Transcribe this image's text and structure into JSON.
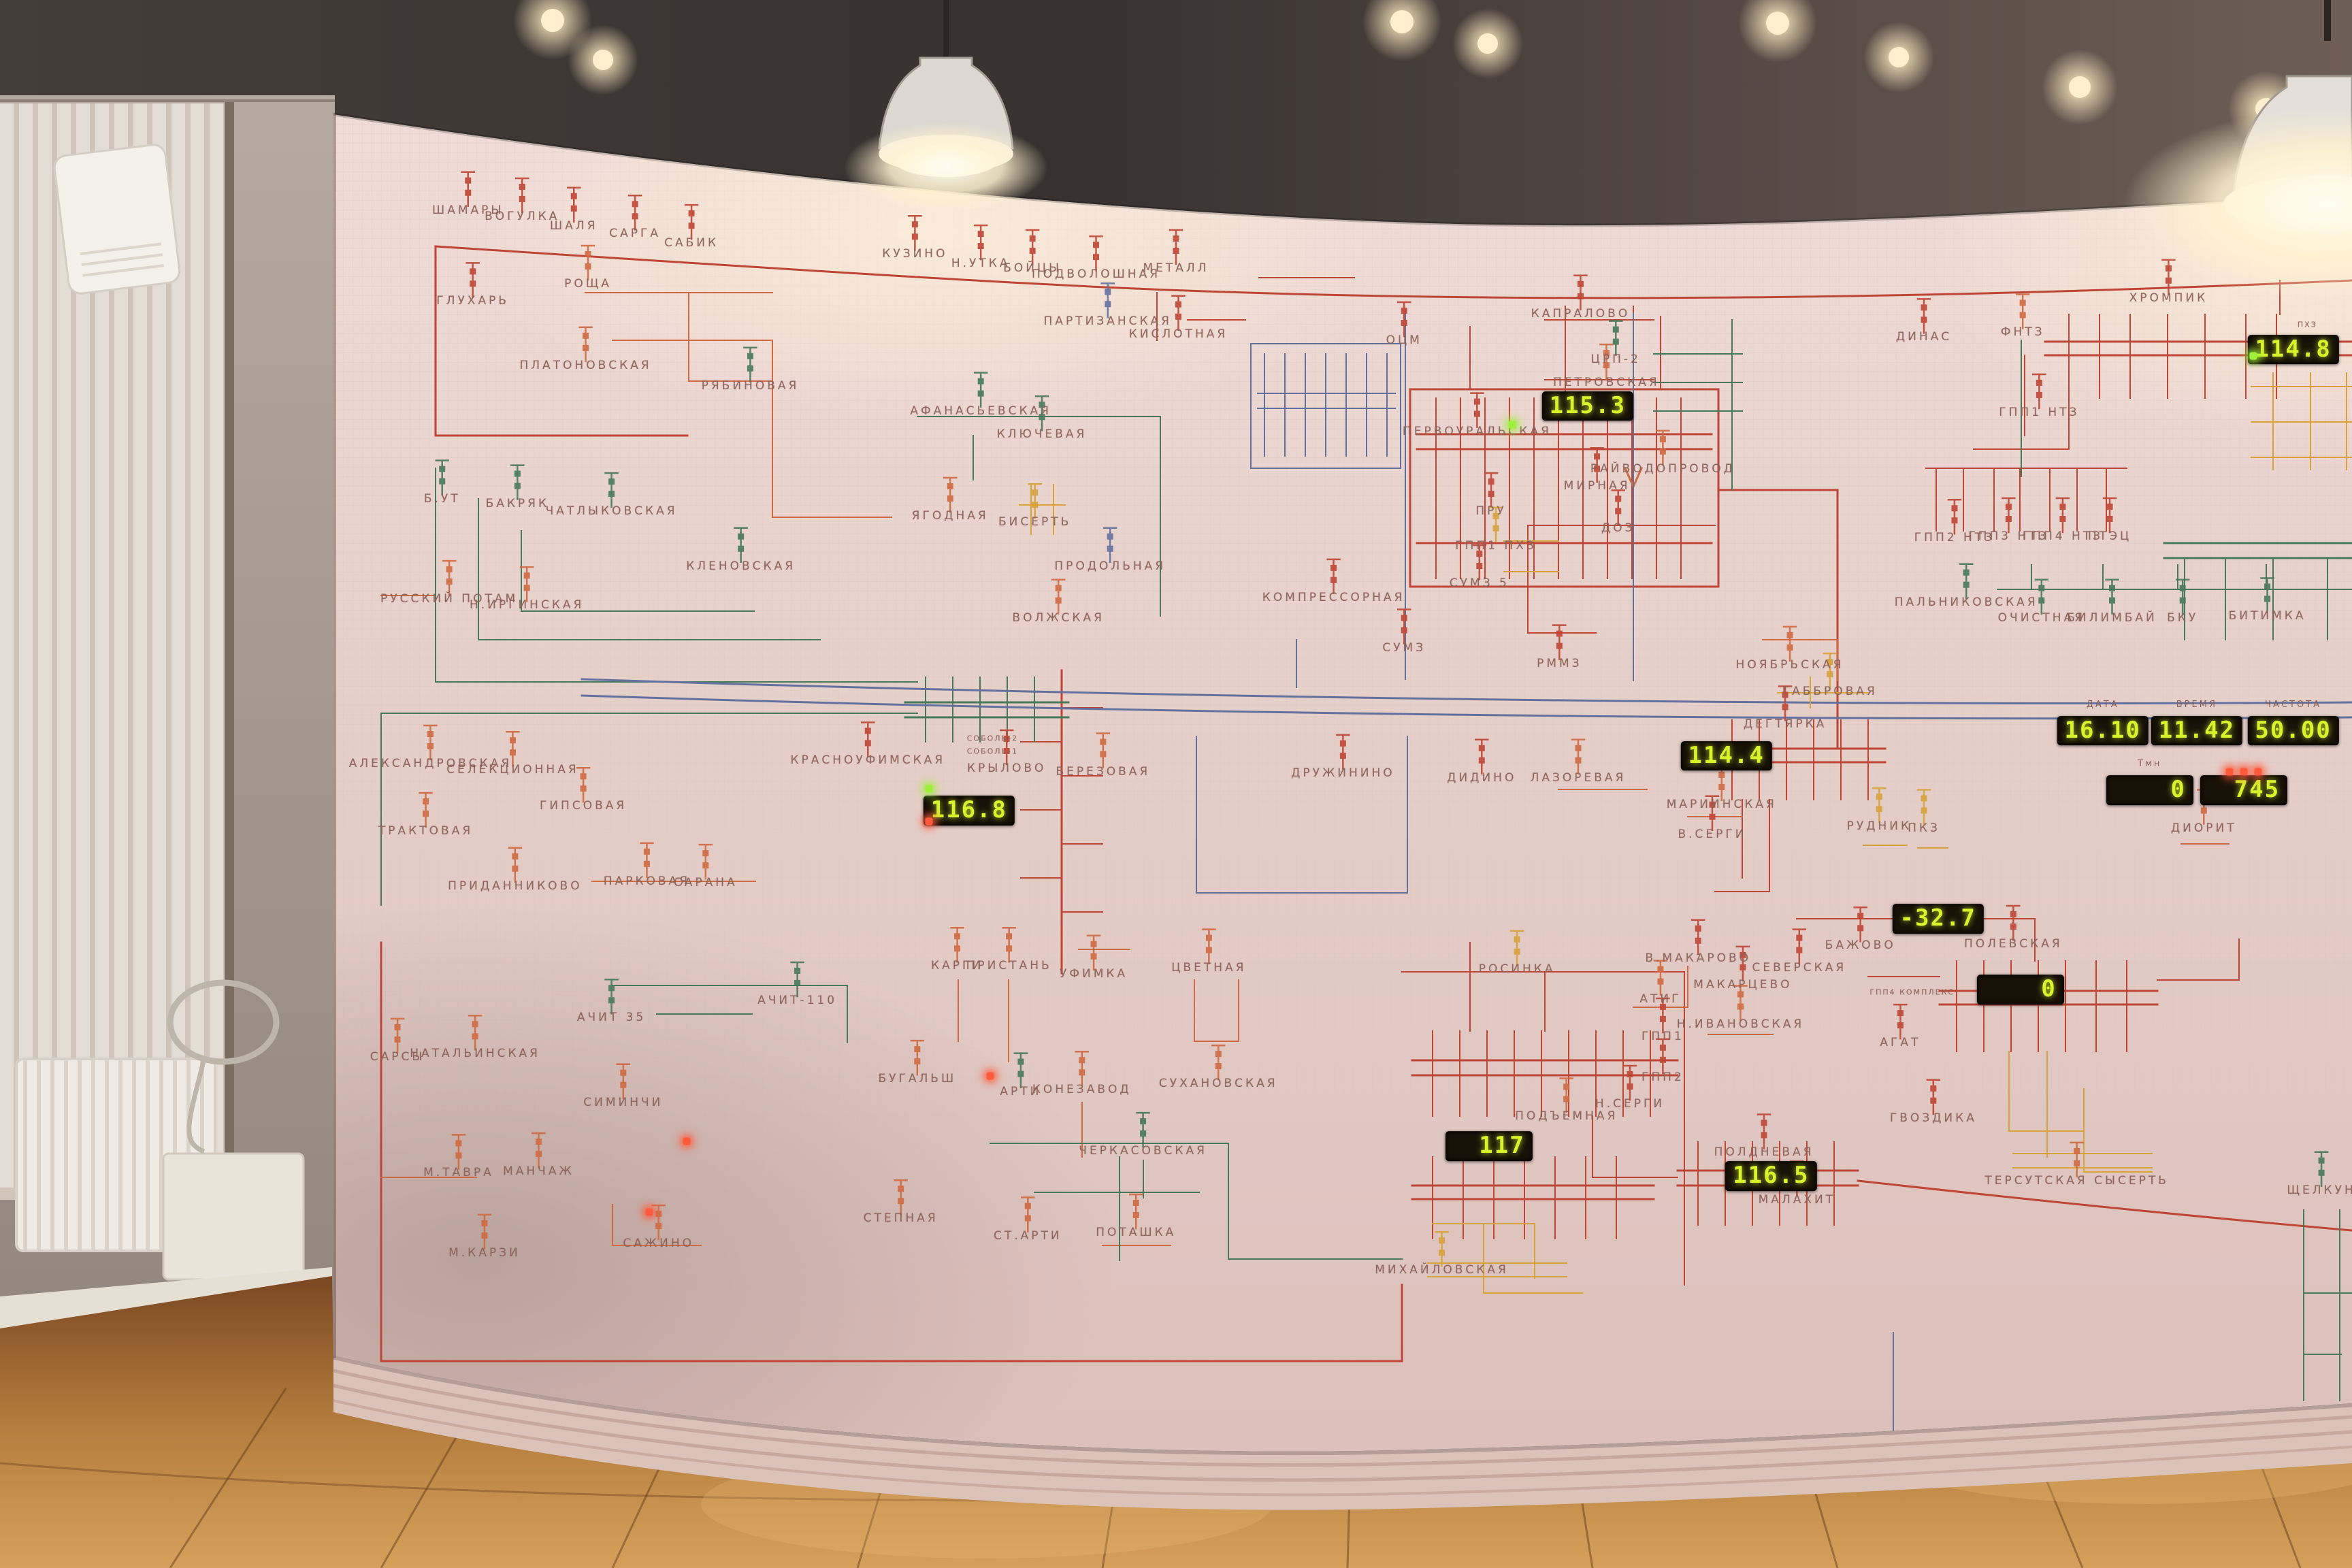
{
  "board": {
    "palette": {
      "red": "#bf4636",
      "orange": "#cf6a42",
      "green": "#47795a",
      "blue": "#63719f",
      "yellow": "#d7a33c",
      "board_bg": "#e8d3cd",
      "digit": "#d8f22c",
      "label_text": "#8a625a",
      "led_green": "#9ef03a",
      "led_red": "#ff5a3c"
    },
    "labels": [
      {
        "t": "ШАМАРЫ",
        "x": 19.9,
        "y": 13.4,
        "c": "red"
      },
      {
        "t": "ВОГУЛКА",
        "x": 22.2,
        "y": 13.8,
        "c": "red"
      },
      {
        "t": "ШАЛЯ",
        "x": 24.4,
        "y": 14.4,
        "c": "red"
      },
      {
        "t": "САРГА",
        "x": 27.0,
        "y": 14.9,
        "c": "red"
      },
      {
        "t": "САБИК",
        "x": 29.4,
        "y": 15.5,
        "c": "red"
      },
      {
        "t": "КУЗИНО",
        "x": 38.9,
        "y": 16.2,
        "c": "red"
      },
      {
        "t": "Н.УТКА",
        "x": 41.7,
        "y": 16.8,
        "c": "red"
      },
      {
        "t": "БОЙЦЫ",
        "x": 43.9,
        "y": 17.1,
        "c": "red"
      },
      {
        "t": "ПОДВОЛОШНАЯ",
        "x": 46.6,
        "y": 17.5,
        "c": "red"
      },
      {
        "t": "МЕТАЛЛ",
        "x": 50.0,
        "y": 17.1,
        "c": "red"
      },
      {
        "t": "ГЛУХАРЬ",
        "x": 20.1,
        "y": 19.2,
        "c": "red"
      },
      {
        "t": "РОЩА",
        "x": 25.0,
        "y": 18.1,
        "c": "orange"
      },
      {
        "t": "ПЛАТОНОВСКАЯ",
        "x": 24.9,
        "y": 23.3,
        "c": "orange"
      },
      {
        "t": "ПАРТИЗАНСКАЯ",
        "x": 47.1,
        "y": 20.5,
        "c": "blue"
      },
      {
        "t": "КИСЛОТНАЯ",
        "x": 50.1,
        "y": 21.3,
        "c": "red"
      },
      {
        "t": "ОЦМ",
        "x": 59.7,
        "y": 21.7,
        "c": "red"
      },
      {
        "t": "КАПРАЛОВО",
        "x": 67.2,
        "y": 20.0,
        "c": "red"
      },
      {
        "t": "ЦРП-2",
        "x": 68.7,
        "y": 22.9,
        "c": "green"
      },
      {
        "t": "ПЕТРОВСКАЯ",
        "x": 68.3,
        "y": 24.4,
        "c": "orange"
      },
      {
        "t": "ПЕРВОУРАЛЬСКАЯ",
        "x": 62.8,
        "y": 27.5,
        "c": "red"
      },
      {
        "t": "РАЙВОДОПРОВОД",
        "x": 70.7,
        "y": 29.9,
        "c": "orange"
      },
      {
        "t": "МИРНАЯ",
        "x": 67.9,
        "y": 31.0,
        "c": "red"
      },
      {
        "t": "ДОЗ",
        "x": 68.8,
        "y": 33.7,
        "c": "red"
      },
      {
        "t": "ПРУ",
        "x": 63.4,
        "y": 32.6,
        "c": "red"
      },
      {
        "t": "ГПП1 ПХЗ",
        "x": 63.6,
        "y": 34.8,
        "c": "yellow"
      },
      {
        "t": "СУМЗ 5",
        "x": 62.9,
        "y": 37.2,
        "c": "red"
      },
      {
        "t": "КОМПРЕССОРНАЯ",
        "x": 56.7,
        "y": 38.1,
        "c": "red"
      },
      {
        "t": "СУМЗ",
        "x": 59.7,
        "y": 41.3,
        "c": "red"
      },
      {
        "t": "РММЗ",
        "x": 66.3,
        "y": 42.3,
        "c": "red"
      },
      {
        "t": "ХРОМПИК",
        "x": 92.2,
        "y": 19.0,
        "c": "red"
      },
      {
        "t": "ПХЗ",
        "x": 98.1,
        "y": 20.7,
        "c": "red",
        "s": 1
      },
      {
        "t": "ДИНАС",
        "x": 81.8,
        "y": 21.5,
        "c": "red"
      },
      {
        "t": "ФНТЗ",
        "x": 86.0,
        "y": 21.2,
        "c": "orange"
      },
      {
        "t": "ГПП1 НТЗ",
        "x": 86.7,
        "y": 26.3,
        "c": "red"
      },
      {
        "t": "ГПП2 НТЗ",
        "x": 83.1,
        "y": 34.3,
        "c": "red"
      },
      {
        "t": "ГПП3 НТЗ",
        "x": 85.4,
        "y": 34.2,
        "c": "red"
      },
      {
        "t": "ГПП4 НТЗ",
        "x": 87.7,
        "y": 34.2,
        "c": "red"
      },
      {
        "t": "ПТЭЦ",
        "x": 89.7,
        "y": 34.2,
        "c": "red"
      },
      {
        "t": "ПАЛЬНИКОВСКАЯ",
        "x": 83.6,
        "y": 38.4,
        "c": "green"
      },
      {
        "t": "ОЧИСТНАЯ",
        "x": 86.8,
        "y": 39.4,
        "c": "green"
      },
      {
        "t": "БИЛИМБАЙ",
        "x": 89.8,
        "y": 39.4,
        "c": "green"
      },
      {
        "t": "БКУ",
        "x": 92.8,
        "y": 39.4,
        "c": "green"
      },
      {
        "t": "БИТИМКА",
        "x": 96.4,
        "y": 39.3,
        "c": "green"
      },
      {
        "t": "РЯБИНОВАЯ",
        "x": 31.9,
        "y": 24.6,
        "c": "green"
      },
      {
        "t": "АФАНАСЬЕВСКАЯ",
        "x": 41.7,
        "y": 26.2,
        "c": "green"
      },
      {
        "t": "КЛЮЧЕВАЯ",
        "x": 44.3,
        "y": 27.7,
        "c": "green"
      },
      {
        "t": "Б.УТ",
        "x": 18.8,
        "y": 31.8,
        "c": "green"
      },
      {
        "t": "БАКРЯК",
        "x": 22.0,
        "y": 32.1,
        "c": "green"
      },
      {
        "t": "ЧАТЛЫКОВСКАЯ",
        "x": 26.0,
        "y": 32.6,
        "c": "green"
      },
      {
        "t": "РУССКИЙ ПОТАМ",
        "x": 19.1,
        "y": 38.2,
        "c": "orange"
      },
      {
        "t": "Н.ИРГИНСКАЯ",
        "x": 22.4,
        "y": 38.6,
        "c": "orange"
      },
      {
        "t": "КЛЕНОВСКАЯ",
        "x": 31.5,
        "y": 36.1,
        "c": "green"
      },
      {
        "t": "ЯГОДНАЯ",
        "x": 40.4,
        "y": 32.9,
        "c": "orange"
      },
      {
        "t": "БИСЕРТЬ",
        "x": 44.0,
        "y": 33.3,
        "c": "yellow"
      },
      {
        "t": "ПРОДОЛЬНАЯ",
        "x": 47.2,
        "y": 36.1,
        "c": "blue"
      },
      {
        "t": "ВОЛЖСКАЯ",
        "x": 45.0,
        "y": 39.4,
        "c": "orange"
      },
      {
        "t": "СОБОЛЬ-2",
        "x": 42.2,
        "y": 47.1,
        "c": "red",
        "s": 1
      },
      {
        "t": "СОБОЛЬ-1",
        "x": 42.2,
        "y": 47.9,
        "c": "red",
        "s": 1
      },
      {
        "t": "КРАСНОУФИМСКАЯ",
        "x": 36.9,
        "y": 48.5,
        "c": "red"
      },
      {
        "t": "КРЫЛОВО",
        "x": 42.8,
        "y": 49.0,
        "c": "red"
      },
      {
        "t": "БЕРЕЗОВАЯ",
        "x": 46.9,
        "y": 49.2,
        "c": "orange"
      },
      {
        "t": "АЛЕКСАНДРОВСКАЯ",
        "x": 18.3,
        "y": 48.7,
        "c": "orange"
      },
      {
        "t": "СЕЛЕКЦИОННАЯ",
        "x": 21.8,
        "y": 49.1,
        "c": "orange"
      },
      {
        "t": "ТРАКТОВАЯ",
        "x": 18.1,
        "y": 53.0,
        "c": "orange"
      },
      {
        "t": "ГИПСОВАЯ",
        "x": 24.8,
        "y": 51.4,
        "c": "orange"
      },
      {
        "t": "ПРИДАННИКОВО",
        "x": 21.9,
        "y": 56.5,
        "c": "orange"
      },
      {
        "t": "ПАРКОВАЯ",
        "x": 27.5,
        "y": 56.2,
        "c": "orange"
      },
      {
        "t": "САРАНА",
        "x": 30.0,
        "y": 56.3,
        "c": "orange"
      },
      {
        "t": "ДРУЖИНИНО",
        "x": 57.1,
        "y": 49.3,
        "c": "red"
      },
      {
        "t": "ДИДИНО",
        "x": 63.0,
        "y": 49.6,
        "c": "red"
      },
      {
        "t": "ЛАЗОРЕВАЯ",
        "x": 67.1,
        "y": 49.6,
        "c": "orange"
      },
      {
        "t": "МАРИИНСКАЯ",
        "x": 73.2,
        "y": 51.3,
        "c": "orange"
      },
      {
        "t": "В.СЕРГИ",
        "x": 72.8,
        "y": 53.2,
        "c": "red"
      },
      {
        "t": "НОЯБРЬСКАЯ",
        "x": 76.1,
        "y": 42.4,
        "c": "orange"
      },
      {
        "t": "ГАББРОВАЯ",
        "x": 77.8,
        "y": 44.1,
        "c": "yellow"
      },
      {
        "t": "ДЕГТЯРКА",
        "x": 75.9,
        "y": 46.2,
        "c": "red"
      },
      {
        "t": "РУДНИК",
        "x": 79.9,
        "y": 52.7,
        "c": "yellow"
      },
      {
        "t": "ПКЗ",
        "x": 81.8,
        "y": 52.8,
        "c": "yellow"
      },
      {
        "t": "ДИОРИТ",
        "x": 93.7,
        "y": 52.8,
        "c": "orange"
      },
      {
        "t": "АЧИТ-110",
        "x": 33.9,
        "y": 63.8,
        "c": "green"
      },
      {
        "t": "АЧИТ 35",
        "x": 26.0,
        "y": 64.9,
        "c": "green"
      },
      {
        "t": "САРСЫ",
        "x": 16.9,
        "y": 67.4,
        "c": "orange"
      },
      {
        "t": "НАТАЛЬИНСКАЯ",
        "x": 20.2,
        "y": 67.2,
        "c": "orange"
      },
      {
        "t": "СИМИНЧИ",
        "x": 26.5,
        "y": 70.3,
        "c": "orange"
      },
      {
        "t": "М.ТАВРА",
        "x": 19.5,
        "y": 74.8,
        "c": "orange"
      },
      {
        "t": "МАНЧАЖ",
        "x": 22.9,
        "y": 74.7,
        "c": "orange"
      },
      {
        "t": "М.КАРЗИ",
        "x": 20.6,
        "y": 79.9,
        "c": "orange"
      },
      {
        "t": "САЖИНО",
        "x": 28.0,
        "y": 79.3,
        "c": "orange"
      },
      {
        "t": "СТЕПНАЯ",
        "x": 38.3,
        "y": 77.7,
        "c": "orange"
      },
      {
        "t": "КАРГИ",
        "x": 40.7,
        "y": 61.6,
        "c": "orange"
      },
      {
        "t": "ПРИСТАНЬ",
        "x": 42.9,
        "y": 61.6,
        "c": "orange"
      },
      {
        "t": "УФИМКА",
        "x": 46.5,
        "y": 62.1,
        "c": "orange"
      },
      {
        "t": "ЦВЕТНАЯ",
        "x": 51.4,
        "y": 61.7,
        "c": "orange"
      },
      {
        "t": "БУГАЛЬШ",
        "x": 39.0,
        "y": 68.8,
        "c": "orange"
      },
      {
        "t": "АРТИ",
        "x": 43.4,
        "y": 69.6,
        "c": "green"
      },
      {
        "t": "КОНЕЗАВОД",
        "x": 46.0,
        "y": 69.5,
        "c": "orange"
      },
      {
        "t": "СУХАНОВСКАЯ",
        "x": 51.8,
        "y": 69.1,
        "c": "orange"
      },
      {
        "t": "ЧЕРКАСОВСКАЯ",
        "x": 48.6,
        "y": 73.4,
        "c": "green"
      },
      {
        "t": "СТ.АРТИ",
        "x": 43.7,
        "y": 78.8,
        "c": "orange"
      },
      {
        "t": "ПОТАШКА",
        "x": 48.3,
        "y": 78.6,
        "c": "orange"
      },
      {
        "t": "РОСИНКА",
        "x": 64.5,
        "y": 61.8,
        "c": "yellow"
      },
      {
        "t": "ПОДЪЕМНАЯ",
        "x": 66.6,
        "y": 71.2,
        "c": "orange"
      },
      {
        "t": "Н.СЕРГИ",
        "x": 69.3,
        "y": 70.4,
        "c": "red"
      },
      {
        "t": "ГПП1",
        "x": 70.7,
        "y": 66.1,
        "c": "red"
      },
      {
        "t": "ГПП2",
        "x": 70.7,
        "y": 68.7,
        "c": "red"
      },
      {
        "t": "АТИГ",
        "x": 70.6,
        "y": 63.7,
        "c": "orange"
      },
      {
        "t": "В.МАКАРОВО",
        "x": 72.2,
        "y": 61.1,
        "c": "red"
      },
      {
        "t": "МАКАРЦЕВО",
        "x": 74.1,
        "y": 62.8,
        "c": "red"
      },
      {
        "t": "СЕВЕРСКАЯ",
        "x": 76.5,
        "y": 61.7,
        "c": "red"
      },
      {
        "t": "Н.ИВАНОВСКАЯ",
        "x": 74.0,
        "y": 65.3,
        "c": "orange"
      },
      {
        "t": "БАЖОВО",
        "x": 79.1,
        "y": 60.3,
        "c": "red"
      },
      {
        "t": "ПОЛЕВСКАЯ",
        "x": 85.6,
        "y": 60.2,
        "c": "red"
      },
      {
        "t": "ГПП4 КОМПЛЕКС",
        "x": 81.3,
        "y": 63.3,
        "c": "red",
        "s": 1
      },
      {
        "t": "АГАТ",
        "x": 80.8,
        "y": 66.5,
        "c": "red"
      },
      {
        "t": "ГВОЗДИКА",
        "x": 82.2,
        "y": 71.3,
        "c": "red"
      },
      {
        "t": "ПОЛДНЕВАЯ",
        "x": 75.0,
        "y": 73.5,
        "c": "red"
      },
      {
        "t": "ТЕРСУТСКАЯ СЫСЕРТЬ",
        "x": 88.3,
        "y": 75.3,
        "c": "orange"
      },
      {
        "t": "ЩЕЛКУН",
        "x": 98.7,
        "y": 75.9,
        "c": "green"
      },
      {
        "t": "МАЛАХИТ",
        "x": 76.4,
        "y": 76.5,
        "c": "red"
      },
      {
        "t": "МИХАЙЛОВСКАЯ",
        "x": 61.3,
        "y": 81.0,
        "c": "yellow"
      }
    ],
    "displays": [
      {
        "v": "114.8",
        "x": 97.5,
        "y": 22.3,
        "w": 4
      },
      {
        "v": "115.3",
        "x": 67.5,
        "y": 25.9,
        "w": 4
      },
      {
        "v": "114.4",
        "x": 73.4,
        "y": 48.2,
        "w": 4
      },
      {
        "v": "116.8",
        "x": 41.2,
        "y": 51.7,
        "w": 4
      },
      {
        "v": "117",
        "x": 63.3,
        "y": 73.1,
        "w": 4
      },
      {
        "v": "116.5",
        "x": 75.3,
        "y": 75.0,
        "w": 4
      },
      {
        "v": "-32.7",
        "x": 82.4,
        "y": 58.6,
        "w": 4
      },
      {
        "v": "0",
        "x": 85.9,
        "y": 63.1,
        "w": 4
      },
      {
        "label": "ДАТА",
        "v": "16.10",
        "x": 89.4,
        "y": 46.6,
        "w": 4
      },
      {
        "label": "ВРЕМЯ",
        "v": "11.42",
        "x": 93.4,
        "y": 46.6,
        "w": 4
      },
      {
        "label": "ЧАСТОТА",
        "v": "50.00",
        "x": 97.5,
        "y": 46.6,
        "w": 4
      },
      {
        "label": "Тмн",
        "v": "0",
        "x": 91.4,
        "y": 50.4,
        "w": 4
      },
      {
        "v": "745",
        "x": 95.4,
        "y": 50.4,
        "w": 4
      }
    ],
    "leds": [
      {
        "x": 39.5,
        "y": 50.3,
        "c": "led_green"
      },
      {
        "x": 39.5,
        "y": 52.4,
        "c": "led_red"
      },
      {
        "x": 42.1,
        "y": 68.6,
        "c": "led_red"
      },
      {
        "x": 29.2,
        "y": 72.8,
        "c": "led_red"
      },
      {
        "x": 27.6,
        "y": 77.3,
        "c": "led_red"
      },
      {
        "x": 95.8,
        "y": 22.7,
        "c": "led_green"
      },
      {
        "x": 64.3,
        "y": 27.1,
        "c": "led_green"
      },
      {
        "x": 94.8,
        "y": 49.2,
        "c": "led_red"
      },
      {
        "x": 95.4,
        "y": 49.2,
        "c": "led_red"
      },
      {
        "x": 96.0,
        "y": 49.2,
        "c": "led_red"
      }
    ]
  }
}
